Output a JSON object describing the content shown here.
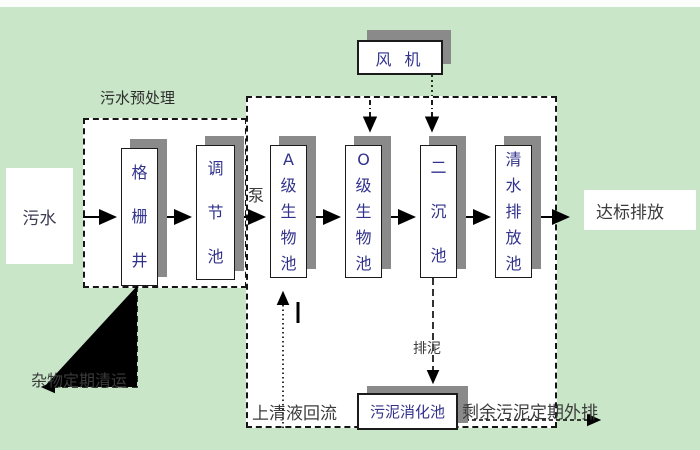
{
  "colors": {
    "background": "#c9e6c9",
    "shadow": "#8a8a8a",
    "tank_text": "#32328c",
    "label_text": "#3b3b3b",
    "border": "#1b1b1b"
  },
  "nodes": {
    "sewage": "污水",
    "grid_well": "格\n栅\n井",
    "regulating_tank": "调\n节\n池",
    "a_bio_tank": "A\n级\n生\n物\n池",
    "o_bio_tank": "O\n级\n生\n物\n池",
    "secondary_sedimentation_tank": "二\n沉\n池",
    "clean_water_discharge_tank": "清\n水\n排\n放\n池",
    "blower": "风 机",
    "sludge_digestion_tank": "污泥消化池",
    "standard_discharge": "达标排放"
  },
  "labels": {
    "pretreatment": "污水预处理",
    "pump": "泵",
    "sludge_discharge": "排泥",
    "supernatant_return": "上清液回流",
    "excess_sludge_outflow": "剩余污泥定期外排",
    "debris_removal": "杂物定期清运"
  }
}
